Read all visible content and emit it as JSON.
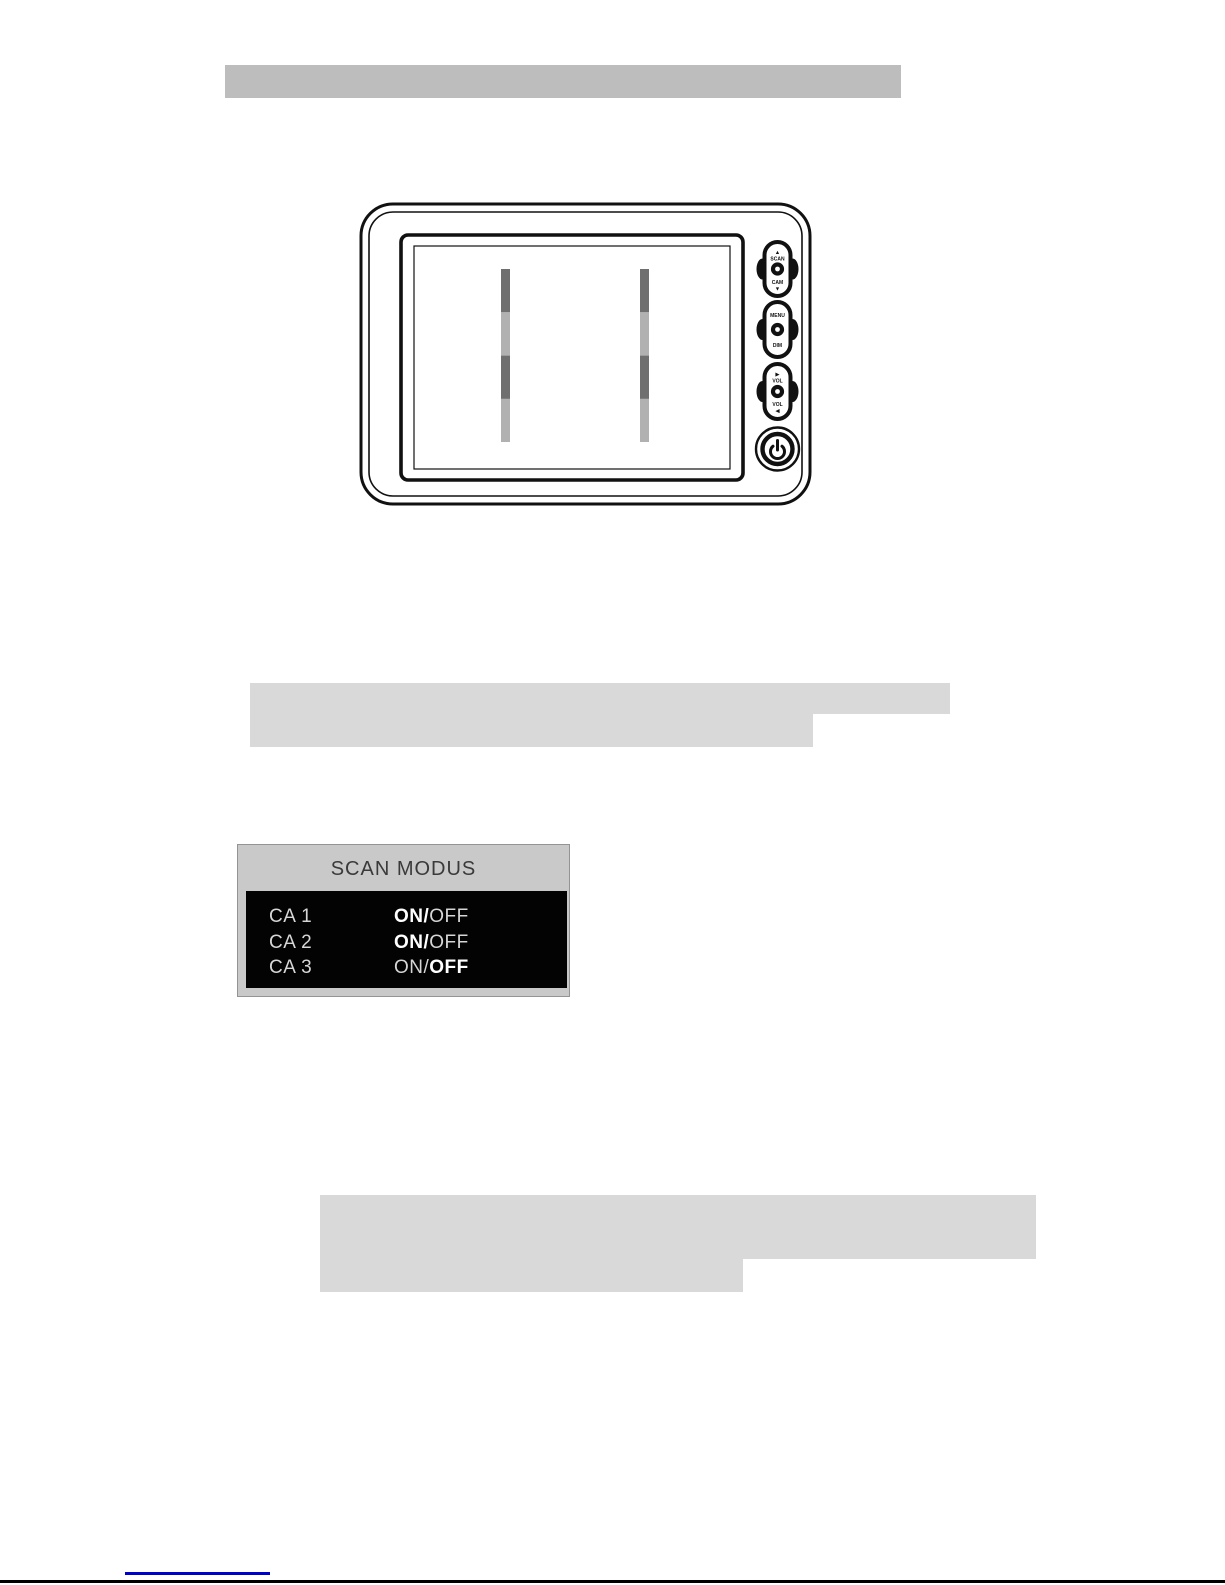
{
  "colors": {
    "header_bar": "#bdbdbd",
    "redacted_block": "#d9d9d9",
    "panel_background": "#c9c9c9",
    "panel_border": "#949494",
    "osd_screen_black": "#030303",
    "osd_title_text": "#3a3a3a",
    "osd_text": "#d6d6d6",
    "osd_text_bold": "#ffffff",
    "link_blue": "#0000cd",
    "signal_bar_dark": "#6f6f6f",
    "signal_bar_light": "#b1b1b1",
    "line_art": "#111111"
  },
  "monitor": {
    "buttons": [
      {
        "top": [
          "▲",
          "SCAN"
        ],
        "bottom": [
          "CAM",
          "▼"
        ]
      },
      {
        "top": [
          "MENU"
        ],
        "bottom": [
          "DIM"
        ]
      },
      {
        "top": [
          "▶",
          "VOL"
        ],
        "bottom": [
          "VOL",
          "◀"
        ]
      }
    ],
    "power_icon": "power-symbol"
  },
  "scan_menu": {
    "title": "SCAN MODUS",
    "rows": [
      {
        "label": "CA 1",
        "value_on": "ON/",
        "value_off": "OFF",
        "bold": "on"
      },
      {
        "label": "CA 2",
        "value_on": "ON/",
        "value_off": "OFF",
        "bold": "on"
      },
      {
        "label": "CA 3",
        "value_on": "ON/",
        "value_off": "OFF",
        "bold": "off"
      }
    ]
  }
}
